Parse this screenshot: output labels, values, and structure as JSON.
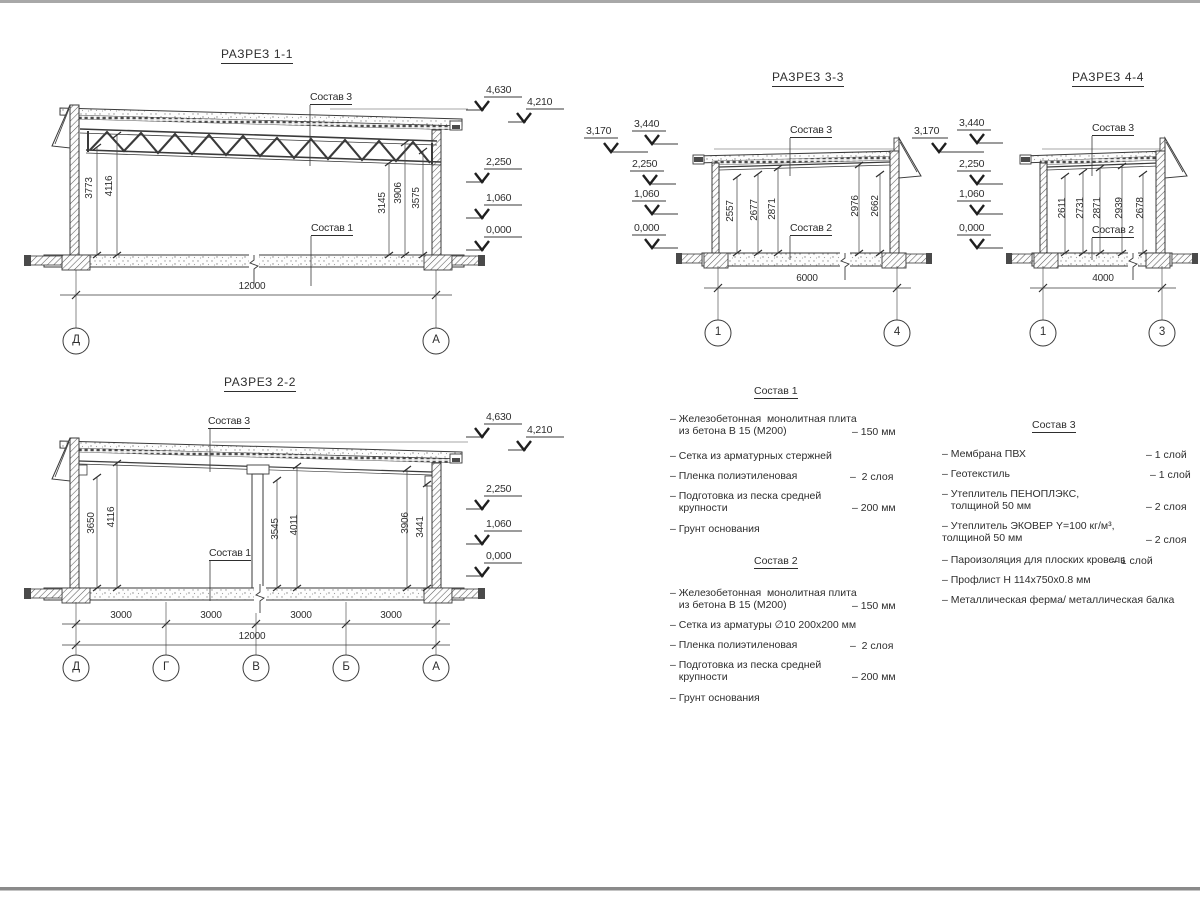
{
  "page": {
    "bg": "#ffffff",
    "line_color": "#3a3a3a"
  },
  "sections": {
    "s11": {
      "title": "РАЗРЕЗ 1-1",
      "sostav_top": "Состав 3",
      "sostav_bottom": "Состав 1",
      "dims": [
        "3773",
        "4116",
        "3145",
        "3906",
        "3575"
      ],
      "total": "12000",
      "grids": [
        "Д",
        "А"
      ],
      "elev": [
        "4,630",
        "4,210",
        "2,250",
        "1,060",
        "0,000"
      ]
    },
    "s22": {
      "title": "РАЗРЕЗ 2-2",
      "sostav_top": "Состав 3",
      "sostav_bottom": "Состав 1",
      "dims": [
        "3650",
        "4116",
        "3545",
        "4011",
        "3906",
        "3441"
      ],
      "spans": [
        "3000",
        "3000",
        "3000",
        "3000"
      ],
      "total": "12000",
      "grids": [
        "Д",
        "Г",
        "В",
        "Б",
        "А"
      ],
      "elev": [
        "4,630",
        "4,210",
        "2,250",
        "1,060",
        "0,000"
      ]
    },
    "s33": {
      "title": "РАЗРЕЗ 3-3",
      "sostav_top": "Состав 3",
      "sostav_bottom": "Состав 2",
      "dims": [
        "2557",
        "2677",
        "2871",
        "2976",
        "2662"
      ],
      "total": "6000",
      "grids": [
        "1",
        "4"
      ],
      "elev": [
        "3,170",
        "3,440",
        "2,250",
        "1,060",
        "0,000"
      ]
    },
    "s44": {
      "title": "РАЗРЕЗ 4-4",
      "sostav_top": "Состав 3",
      "sostav_bottom": "Состав 2",
      "dims": [
        "2611",
        "2731",
        "2871",
        "2939",
        "2678"
      ],
      "total": "4000",
      "grids": [
        "1",
        "3"
      ],
      "elev": [
        "3,170",
        "3,440",
        "2,250",
        "1,060",
        "0,000"
      ]
    }
  },
  "specs": {
    "s1": {
      "title": "Состав 1",
      "items": [
        {
          "name": "– Железобетонная  монолитная плита\n   из бетона В 15 (М200)",
          "value": "– 150 мм"
        },
        {
          "name": "– Сетка из арматурных стержней",
          "value": ""
        },
        {
          "name": "– Пленка полиэтиленовая",
          "value": "–  2 слоя"
        },
        {
          "name": "– Подготовка из песка средней\n   крупности",
          "value": "– 200 мм"
        },
        {
          "name": "– Грунт основания",
          "value": ""
        }
      ]
    },
    "s2": {
      "title": "Состав 2",
      "items": [
        {
          "name": "– Железобетонная  монолитная плита\n   из бетона В 15 (М200)",
          "value": "– 150 мм"
        },
        {
          "name": "– Сетка из арматуры ∅10 200х200 мм",
          "value": ""
        },
        {
          "name": "– Пленка полиэтиленовая",
          "value": "–  2 слоя"
        },
        {
          "name": "– Подготовка из песка средней\n   крупности",
          "value": "– 200 мм"
        },
        {
          "name": "– Грунт основания",
          "value": ""
        }
      ]
    },
    "s3": {
      "title": "Состав 3",
      "items": [
        {
          "name": "– Мембрана ПВХ",
          "value": "– 1 слой"
        },
        {
          "name": "– Геотекстиль",
          "value": "– 1 слой"
        },
        {
          "name": "– Утеплитель ПЕНОПЛЭКС,\n   толщиной 50 мм",
          "value": "– 2 слоя"
        },
        {
          "name": "– Утеплитель ЭКОВЕР Y=100 кг/м³,\nтолщиной 50 мм",
          "value": "– 2 слоя"
        },
        {
          "name": "– Пароизоляция для плоских кровель",
          "value": "– 1 слой"
        },
        {
          "name": "– Профлист Н 114х750х0.8 мм",
          "value": ""
        },
        {
          "name": "– Металлическая ферма/ металлическая балка",
          "value": ""
        }
      ]
    }
  }
}
